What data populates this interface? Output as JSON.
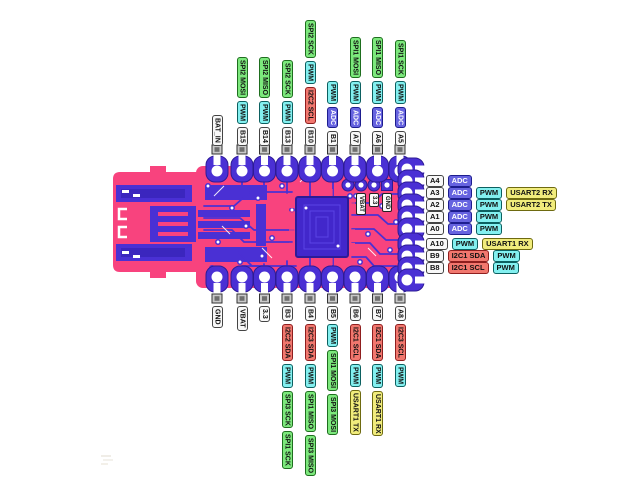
{
  "page": {
    "background": "#ffffff"
  },
  "diagram": {
    "type": "microcontroller-pinout",
    "board": {
      "onboard_labels": [
        "VBAT",
        "3.3",
        "GND"
      ],
      "colors": {
        "board_pink": "#F8437E",
        "copper_indigo": "#4A30D4",
        "copper_dark": "#2D1B96",
        "copper_inner": "#3B26BE",
        "chip_fill": "#4227CB",
        "chip_trace": "#5B43E6",
        "pad_hole": "#FFFFFF",
        "tab_gray": "#C9C9C9",
        "tab_gray_dark": "#6E6E6E"
      }
    },
    "legend_colors": {
      "pin": {
        "bg": "#F8F8F8",
        "fg": "#111111",
        "bd": "#444444"
      },
      "power": {
        "bg": "#F8F8F8",
        "fg": "#111111",
        "bd": "#444444"
      },
      "adc": {
        "bg": "#6663E0",
        "fg": "#FFFFFF",
        "bd": "#1D1D8F"
      },
      "pwm": {
        "bg": "#83F0F0",
        "fg": "#111111",
        "bd": "#0C6060"
      },
      "spi": {
        "bg": "#7CE87C",
        "fg": "#111111",
        "bd": "#1E6E1E"
      },
      "i2c": {
        "bg": "#F1776E",
        "fg": "#111111",
        "bd": "#8F1E1E"
      },
      "usart": {
        "bg": "#F1EC7C",
        "fg": "#111111",
        "bd": "#6E6A10"
      }
    },
    "pins": {
      "top": [
        {
          "name": "BAT_IN",
          "type": "power",
          "functions": []
        },
        {
          "name": "B15",
          "type": "pin",
          "functions": [
            {
              "label": "PWM",
              "type": "pwm"
            },
            {
              "label": "SPI2 MOSI",
              "type": "spi"
            }
          ]
        },
        {
          "name": "B14",
          "type": "pin",
          "functions": [
            {
              "label": "PWM",
              "type": "pwm"
            },
            {
              "label": "SPI2 MISO",
              "type": "spi"
            }
          ]
        },
        {
          "name": "B13",
          "type": "pin",
          "functions": [
            {
              "label": "PWM",
              "type": "pwm"
            },
            {
              "label": "SPI2 SCK",
              "type": "spi"
            }
          ]
        },
        {
          "name": "B10",
          "type": "pin",
          "functions": [
            {
              "label": "I2C2 SCL",
              "type": "i2c"
            },
            {
              "label": "PWM",
              "type": "pwm"
            },
            {
              "label": "SPI2 SCK",
              "type": "spi"
            }
          ]
        },
        {
          "name": "B1",
          "type": "pin",
          "functions": [
            {
              "label": "ADC",
              "type": "adc"
            },
            {
              "label": "PWM",
              "type": "pwm"
            }
          ]
        },
        {
          "name": "A7",
          "type": "pin",
          "functions": [
            {
              "label": "ADC",
              "type": "adc"
            },
            {
              "label": "PWM",
              "type": "pwm"
            },
            {
              "label": "SPI1 MOSI",
              "type": "spi"
            }
          ]
        },
        {
          "name": "A6",
          "type": "pin",
          "functions": [
            {
              "label": "ADC",
              "type": "adc"
            },
            {
              "label": "PWM",
              "type": "pwm"
            },
            {
              "label": "SPI1 MISO",
              "type": "spi"
            }
          ]
        },
        {
          "name": "A5",
          "type": "pin",
          "functions": [
            {
              "label": "ADC",
              "type": "adc"
            },
            {
              "label": "PWM",
              "type": "pwm"
            },
            {
              "label": "SPI1 SCK",
              "type": "spi"
            }
          ]
        }
      ],
      "bottom": [
        {
          "name": "GND",
          "type": "power",
          "functions": []
        },
        {
          "name": "VBAT",
          "type": "power",
          "functions": []
        },
        {
          "name": "3.3",
          "type": "power",
          "functions": []
        },
        {
          "name": "B3",
          "type": "pin",
          "functions": [
            {
              "label": "I2C2 SDA",
              "type": "i2c"
            },
            {
              "label": "PWM",
              "type": "pwm"
            },
            {
              "label": "SPI3 SCK",
              "type": "spi"
            },
            {
              "label": "SPI1 SCK",
              "type": "spi"
            }
          ]
        },
        {
          "name": "B4",
          "type": "pin",
          "functions": [
            {
              "label": "I2C3 SDA",
              "type": "i2c"
            },
            {
              "label": "PWM",
              "type": "pwm"
            },
            {
              "label": "SPI1 MISO",
              "type": "spi"
            },
            {
              "label": "SPI3 MISO",
              "type": "spi"
            }
          ]
        },
        {
          "name": "B5",
          "type": "pin",
          "functions": [
            {
              "label": "PWM",
              "type": "pwm"
            },
            {
              "label": "SPI1 MOSI",
              "type": "spi"
            },
            {
              "label": "SPI3 MOSI",
              "type": "spi"
            }
          ]
        },
        {
          "name": "B6",
          "type": "pin",
          "functions": [
            {
              "label": "I2C1 SCL",
              "type": "i2c"
            },
            {
              "label": "PWM",
              "type": "pwm"
            },
            {
              "label": "USART1 TX",
              "type": "usart"
            }
          ]
        },
        {
          "name": "B7",
          "type": "pin",
          "functions": [
            {
              "label": "I2C1 SDA",
              "type": "i2c"
            },
            {
              "label": "PWM",
              "type": "pwm"
            },
            {
              "label": "USART1 RX",
              "type": "usart"
            }
          ]
        },
        {
          "name": "A8",
          "type": "pin",
          "functions": [
            {
              "label": "I2C3 SCL",
              "type": "i2c"
            },
            {
              "label": "PWM",
              "type": "pwm"
            }
          ]
        }
      ],
      "right": [
        {
          "name": "A4",
          "type": "pin",
          "functions": [
            {
              "label": "ADC",
              "type": "adc"
            }
          ]
        },
        {
          "name": "A3",
          "type": "pin",
          "functions": [
            {
              "label": "ADC",
              "type": "adc"
            },
            {
              "label": "PWM",
              "type": "pwm"
            },
            {
              "label": "USART2 RX",
              "type": "usart"
            }
          ]
        },
        {
          "name": "A2",
          "type": "pin",
          "functions": [
            {
              "label": "ADC",
              "type": "adc"
            },
            {
              "label": "PWM",
              "type": "pwm"
            },
            {
              "label": "USART2 TX",
              "type": "usart"
            }
          ]
        },
        {
          "name": "A1",
          "type": "pin",
          "functions": [
            {
              "label": "ADC",
              "type": "adc"
            },
            {
              "label": "PWM",
              "type": "pwm"
            }
          ]
        },
        {
          "name": "A0",
          "type": "pin",
          "functions": [
            {
              "label": "ADC",
              "type": "adc"
            },
            {
              "label": "PWM",
              "type": "pwm"
            }
          ]
        },
        {
          "name": "A10",
          "type": "pin",
          "functions": [
            {
              "label": "PWM",
              "type": "pwm"
            },
            {
              "label": "USART1 RX",
              "type": "usart"
            }
          ]
        },
        {
          "name": "B9",
          "type": "pin",
          "functions": [
            {
              "label": "I2C1 SDA",
              "type": "i2c"
            },
            {
              "label": "PWM",
              "type": "pwm"
            }
          ]
        },
        {
          "name": "B8",
          "type": "pin",
          "functions": [
            {
              "label": "I2C1 SCL",
              "type": "i2c"
            },
            {
              "label": "PWM",
              "type": "pwm"
            }
          ]
        }
      ]
    }
  }
}
